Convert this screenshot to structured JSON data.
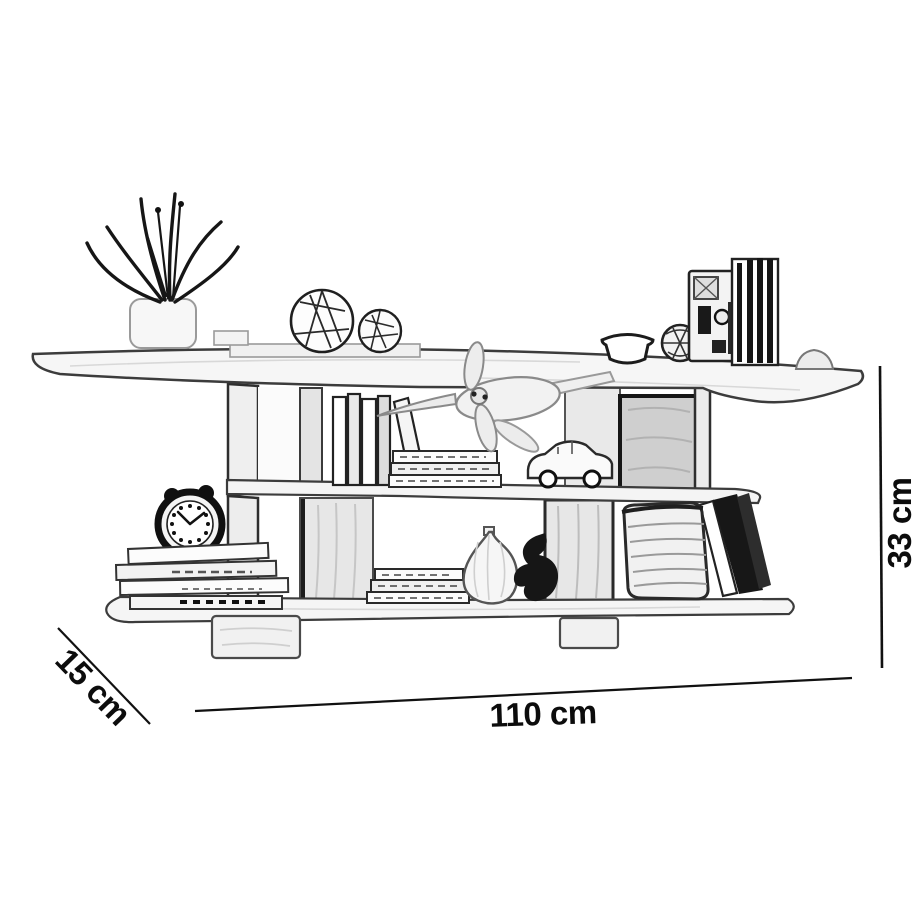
{
  "diagram": {
    "type": "product-dimension-sketch",
    "subject": "wall-mounted two-tier shelf with decor items",
    "dimension_labels": {
      "width": "110 cm",
      "height": "33 cm",
      "depth": "15 cm"
    },
    "colors": {
      "background": "#ffffff",
      "ink": "#1a1a1a",
      "panel_shade": "#e7e7e7",
      "dark_panel": "#cfcfcf"
    },
    "sketch_items": [
      "potted-plant",
      "decor-sphere-large",
      "decor-sphere-small",
      "decor-bowl",
      "decor-lattice-ball",
      "decor-camera",
      "decor-book-row",
      "decor-dome",
      "upright-books",
      "leaning-book",
      "upper-book-stack",
      "toy-plane",
      "toy-car",
      "alarm-clock",
      "lower-book-stack-left",
      "lower-book-stack-mid",
      "decor-vase",
      "decor-figurine",
      "storage-basket",
      "top-shelf",
      "middle-shelf",
      "bottom-shelf",
      "mounting-brackets"
    ]
  }
}
